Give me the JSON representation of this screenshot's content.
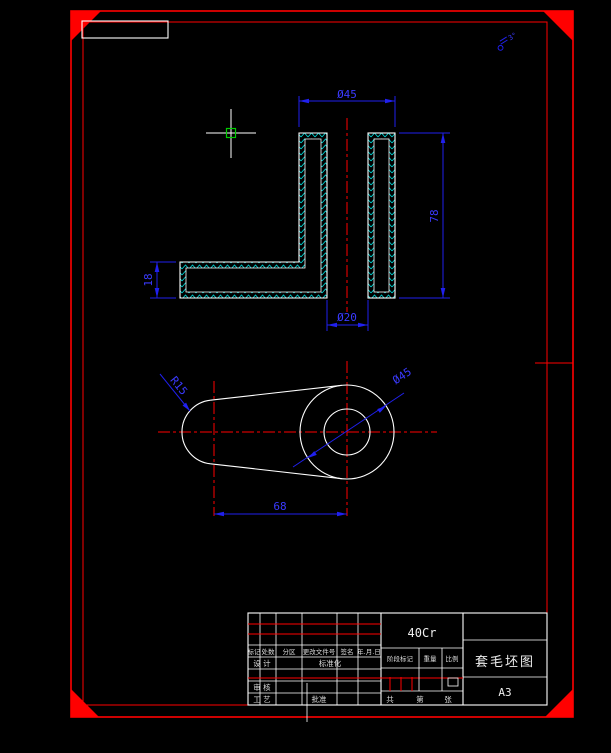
{
  "canvas": {
    "background": "#000000"
  },
  "colors": {
    "frame_red": "#ff0000",
    "dimension_blue": "#2020ee",
    "hatch_cyan": "#00dcdc",
    "outline_white": "#ffffff",
    "pickbox_green": "#00cc00"
  },
  "section_view": {
    "dim_outer_diameter": "Ø45",
    "dim_height": "78",
    "dim_base_thickness": "18",
    "dim_bore": "Ø20"
  },
  "plan_view": {
    "dim_center_distance": "68",
    "dim_end_radius": "R15",
    "dim_boss_diameter": "Ø45"
  },
  "annotation": {
    "draft_note": "3°"
  },
  "title_block": {
    "material": "40Cr",
    "title": "套毛坯图",
    "sheet": "A3",
    "header": {
      "mark": "标记",
      "count": "处数",
      "zone": "分区",
      "change_no": "更改文件号",
      "sign": "签名",
      "date": "年.月.日"
    },
    "design": "设 计",
    "standardize": "标准化",
    "review": "审 核",
    "process": "工 艺",
    "approve": "批准",
    "stage": "阶段标记",
    "weight": "重量",
    "scale": "比例",
    "total": "共",
    "no": "第",
    "sheets": "张"
  }
}
